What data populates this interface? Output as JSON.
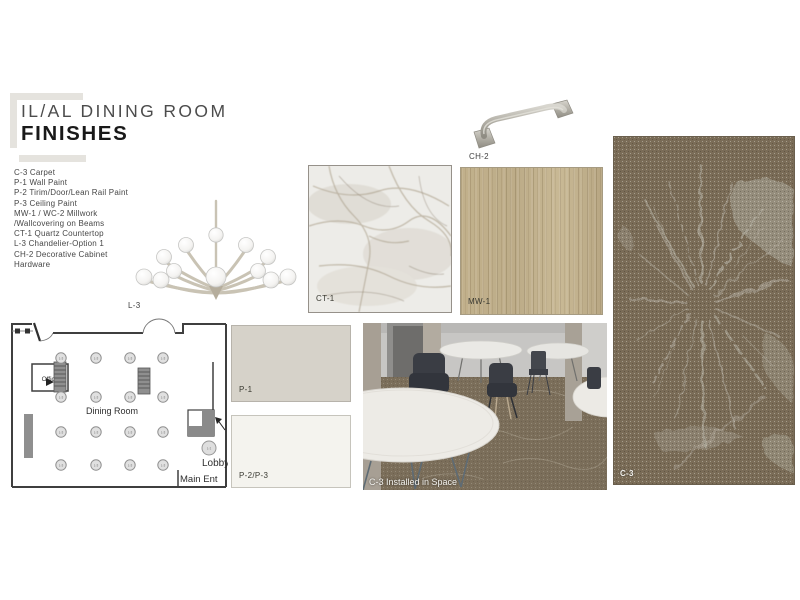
{
  "header": {
    "title_line1": "IL/AL DINING ROOM",
    "title_line2": "FINISHES",
    "accent_color": "#e5e3de"
  },
  "finish_list": {
    "items": [
      "C-3 Carpet",
      "P-1 Wall Paint",
      "P-2 Tirim/Door/Lean Rail Paint",
      "P-3 Ceiling Paint",
      "MW-1 / WC-2 Millwork",
      "/Wallcovering on Beams",
      "CT-1 Quartz Countertop",
      "L-3 Chandelier-Option 1",
      "CH-2 Decorative Cabinet",
      "Hardware"
    ]
  },
  "labels": {
    "chandelier": "L-3",
    "hardware": "CH-2",
    "countertop": "CT-1",
    "millwork": "MW-1",
    "paint_p1": "P-1",
    "paint_p2p3": "P-2/P-3",
    "carpet": "C-3",
    "installed_photo": "C-3 Installed in Space"
  },
  "floor_plan": {
    "office": "Office",
    "dining_room": "Dining Room",
    "lobby": "Lobby",
    "main_entrance": "Main Ent",
    "light_symbol": "L-3",
    "lobby_light_symbol": "L-1"
  },
  "colors": {
    "paint_p1": "#d6d2c9",
    "paint_p2p3": "#f4f3ee",
    "millwork_wood": "#c6b692",
    "carpet_base": "#7a6c57",
    "carpet_pattern": "#b5b1a4",
    "hardware_metal": "#b3b0a7"
  }
}
